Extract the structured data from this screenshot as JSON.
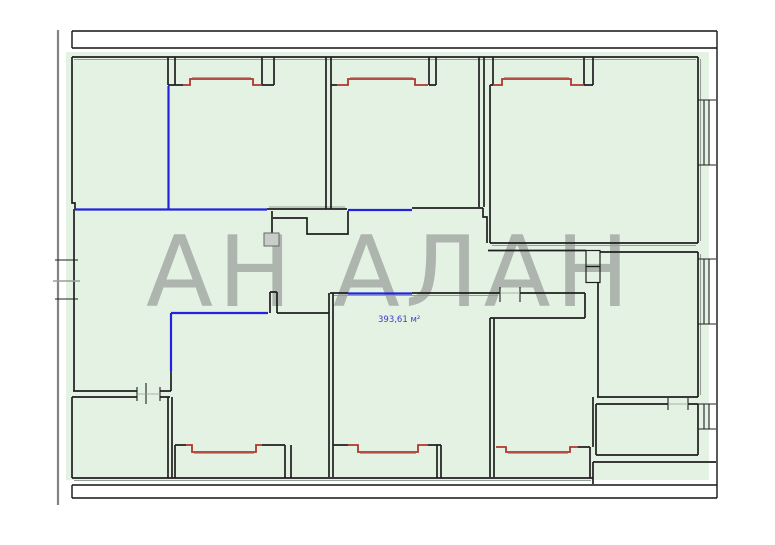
{
  "plan": {
    "watermark": "АН АЛАН",
    "area_label": "393,61 м²"
  },
  "colors": {
    "background": "#ffffff",
    "floor_fill": "#e4f2e4",
    "wall": "#1f1f1f",
    "wall_shadow": "#97a097",
    "frame": "#141414",
    "guide_gray": "#848484",
    "partition_red": "#ad372c",
    "partition_red_light": "#d99186",
    "partition_blue": "#2323dc",
    "watermark_gray": "#aeb4ae",
    "label_blue": "#3c3ccd",
    "duct_fill": "#c9cdc9"
  }
}
